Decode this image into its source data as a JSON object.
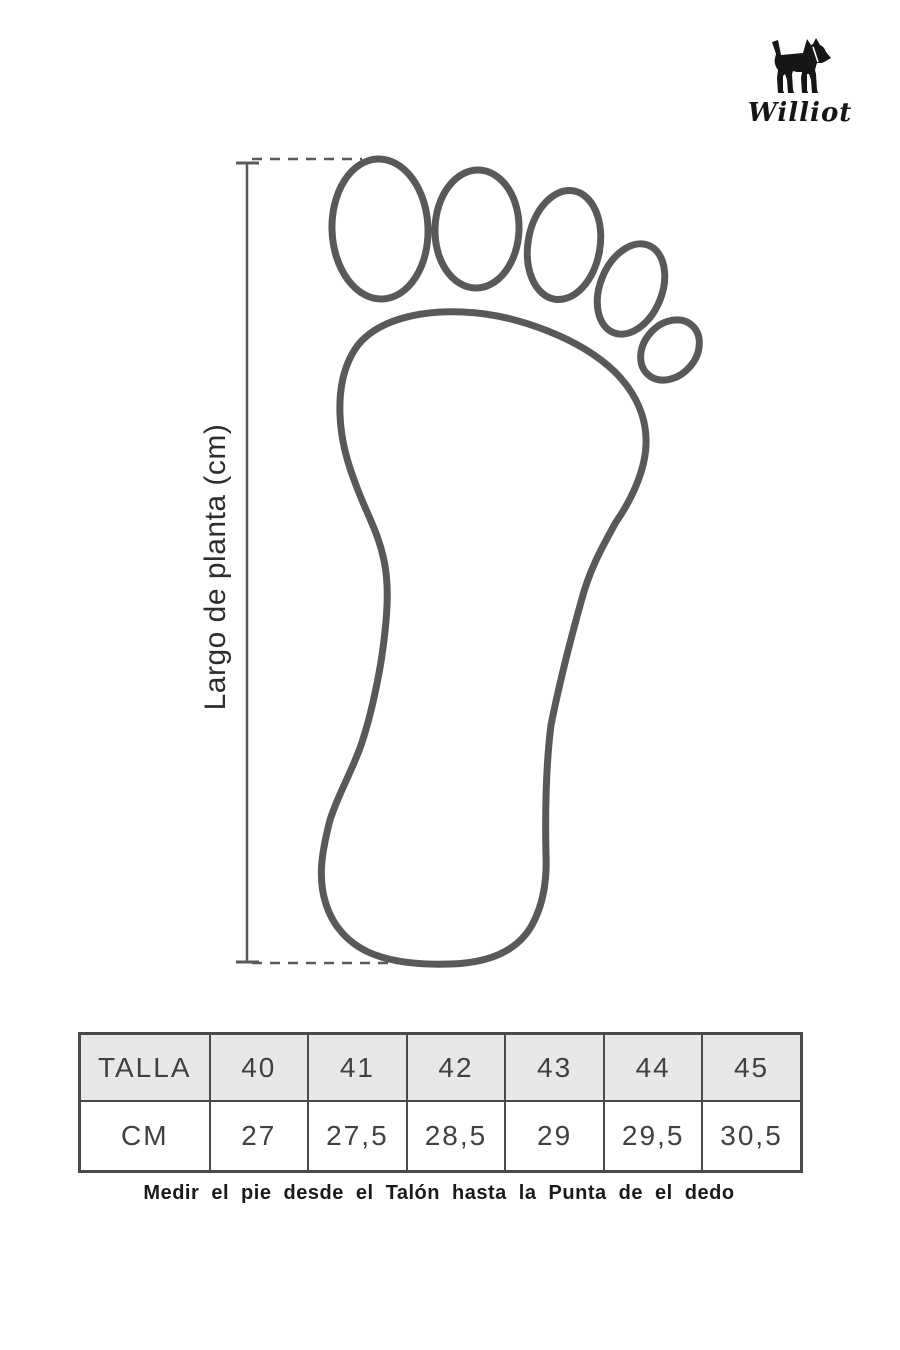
{
  "brand": {
    "name": "Williot"
  },
  "diagram": {
    "axis_label": "Largo de planta (cm)"
  },
  "size_table": {
    "rows": [
      {
        "label": "TALLA",
        "values": [
          "40",
          "41",
          "42",
          "43",
          "44",
          "45"
        ]
      },
      {
        "label": "CM",
        "values": [
          "27",
          "27,5",
          "28,5",
          "29",
          "29,5",
          "30,5"
        ]
      }
    ]
  },
  "caption": "Medir el pie desde el Talón hasta la Punta de el dedo",
  "icons": {
    "logo": "terrier-dog-icon",
    "diagram": "foot-outline-diagram"
  },
  "colors": {
    "outline_gray": "#58595b",
    "table_border": "#4a4a4c",
    "table_text": "#414042",
    "header_bg": "#e8e8e8",
    "logo_black": "#161616"
  }
}
